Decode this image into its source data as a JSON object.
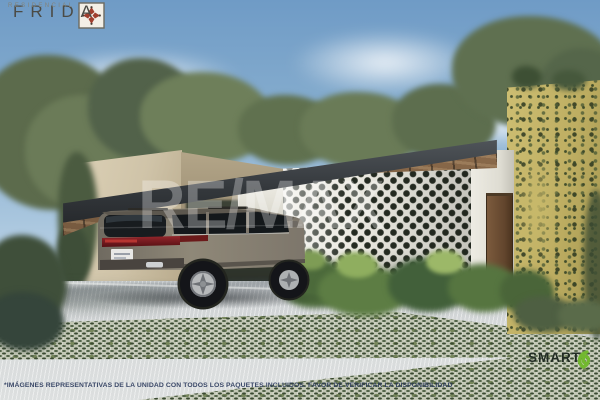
{
  "branding": {
    "frida_logo": {
      "icon": "talavera-tile-icon",
      "name": "FRIDA",
      "subtitle": "RESIDENCIAL"
    },
    "remax_watermark": {
      "text": "RE/MAX"
    },
    "smart_logo": {
      "icon": "green-leaf-swirl-icon",
      "name": "SMART"
    }
  },
  "disclaimer": {
    "text": "*IMÁGENES REPRESENTATIVAS DE LA UNIDAD CON TODOS LOS PAQUETES INCLUIDOS. FAVOR DE VERIFICAR LA DISPONIBILIDAD"
  },
  "scene": {
    "subject": "architectural-render-house-with-breeze-block-facade-carport-and-gray-suv",
    "elements": [
      "sky",
      "clouds",
      "trees",
      "beige-stucco-wall",
      "breeze-block-lattice-wall",
      "wood-door",
      "yellow-vine-covered-wall",
      "flat-carport-pergola",
      "gray-suv",
      "tropical-plants",
      "concrete-driveway",
      "grass-paver-bands"
    ]
  },
  "colors": {
    "sky_top": "#6f9bc6",
    "sky_bottom": "#e3ecf2",
    "foliage": "#5f7050",
    "beige_wall": "#cfc3a8",
    "yellow_wall": "#beae62",
    "lattice_block": "#eceae2",
    "lattice_hole": "#242a21",
    "carport_fascia": "#34383c",
    "soffit_wood": "#826244",
    "door_wood": "#62452d",
    "suv_body": "#87806f",
    "driveway": "#d6d9da",
    "grass_paver": "#54654a",
    "frida_tile_red": "#a03f2e",
    "smart_green": "#72b82f",
    "disclaimer_text": "#2d3c5e",
    "watermark_white": "rgba(255,255,255,0.30)"
  }
}
